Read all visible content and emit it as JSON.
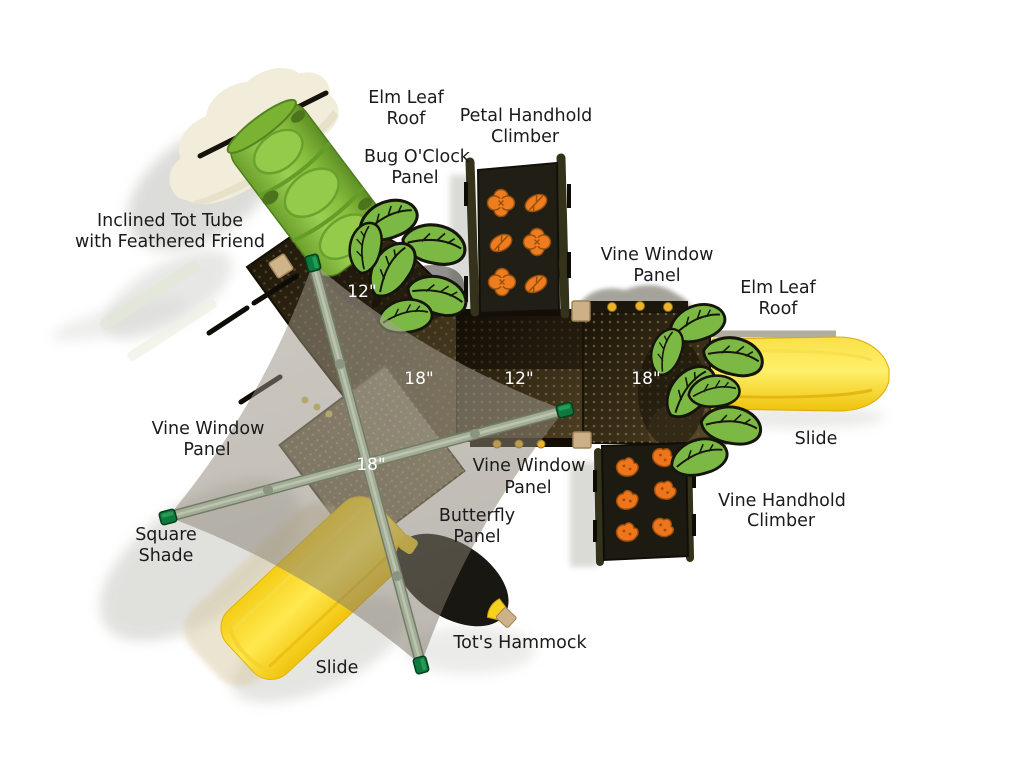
{
  "diagram_type": "playground-structure-top-view",
  "component_labels": {
    "elm_leaf_roof_top": {
      "line1": "Elm Leaf",
      "line2": "Roof"
    },
    "petal_handhold_climber": {
      "line1": "Petal Handhold",
      "line2": "Climber"
    },
    "bug_oclock_panel": {
      "line1": "Bug O'Clock",
      "line2": "Panel"
    },
    "inclined_tot_tube": {
      "line1": "Inclined Tot Tube",
      "line2": "with Feathered Friend"
    },
    "vine_window_panel_right": {
      "line1": "Vine Window",
      "line2": "Panel"
    },
    "elm_leaf_roof_right": {
      "line1": "Elm Leaf",
      "line2": "Roof"
    },
    "vine_window_panel_left": {
      "line1": "Vine Window",
      "line2": "Panel"
    },
    "slide_right": {
      "line1": "Slide"
    },
    "vine_window_panel_center": {
      "line1": "Vine Window",
      "line2": "Panel"
    },
    "butterfly_panel": {
      "line1": "Butterfly",
      "line2": "Panel"
    },
    "vine_handhold_climber": {
      "line1": "Vine Handhold",
      "line2": "Climber"
    },
    "square_shade": {
      "line1": "Square",
      "line2": "Shade"
    },
    "tots_hammock": {
      "line1": "Tot's Hammock"
    },
    "slide_bottom": {
      "line1": "Slide"
    }
  },
  "deck_dimensions": {
    "tube_deck": "12\"",
    "upper_deck": "18\"",
    "middle_deck": "12\"",
    "right_deck": "18\"",
    "lower_deck": "18\""
  },
  "colors": {
    "background": "#ffffff",
    "leaf_green": "#7cb944",
    "tube_green": "#8ec648",
    "slide_yellow": "#ffe83e",
    "handhold_orange": "#ee7a1e",
    "deck_brown": "#352a16",
    "shade_fabric_tan": "#918a7c",
    "pole_sage": "#a3ad97",
    "cap_green": "#0d7a3d",
    "roof_cream": "#f1edda",
    "window_dot_yellow": "#edb32a",
    "label_text": "#1b1b1b",
    "dimension_text": "#ffffff"
  }
}
